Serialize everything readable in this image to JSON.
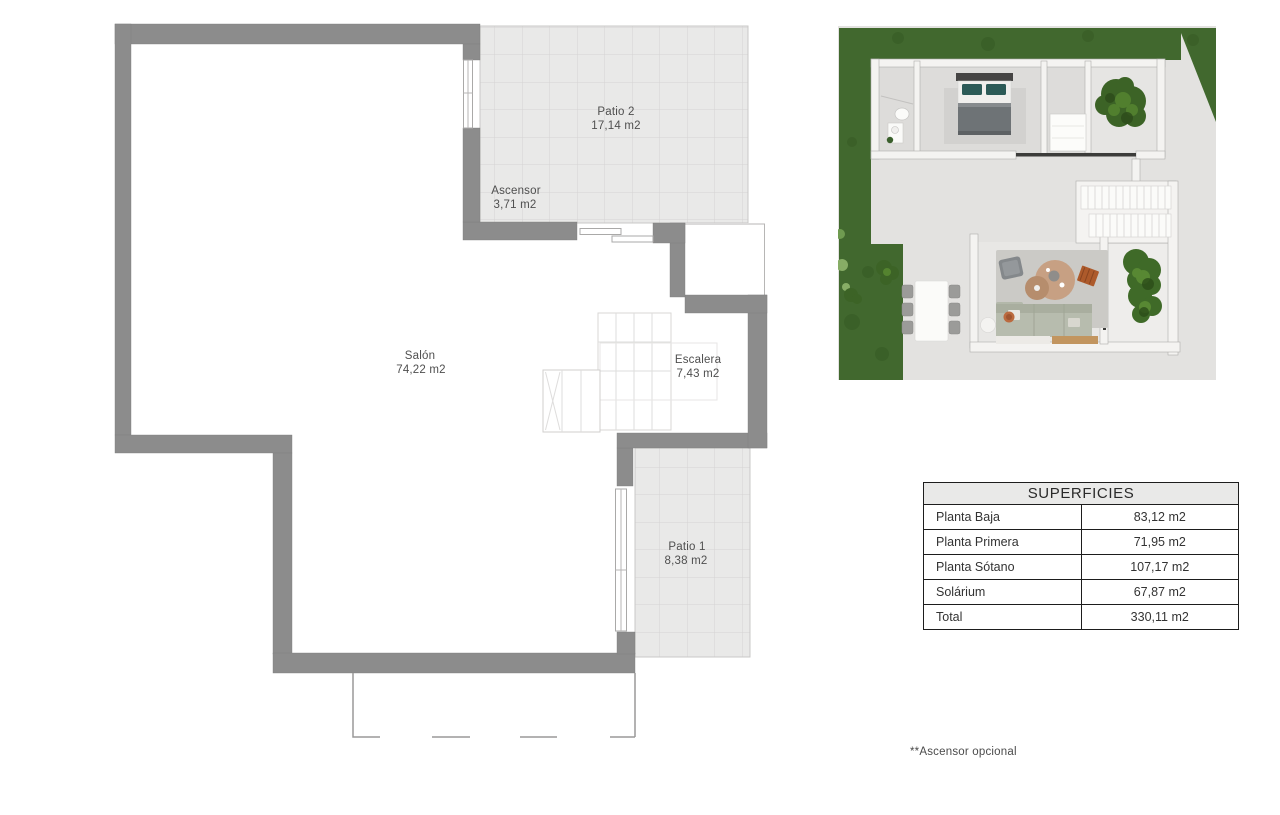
{
  "floorplan": {
    "labels": {
      "patio2": {
        "name": "Patio 2",
        "area": "17,14 m2"
      },
      "ascensor": {
        "name": "Ascensor",
        "area": "3,71 m2"
      },
      "salon": {
        "name": "Salón",
        "area": "74,22 m2"
      },
      "escalera": {
        "name": "Escalera",
        "area": "7,43 m2"
      },
      "patio1": {
        "name": "Patio 1",
        "area": "8,38 m2"
      }
    },
    "colors": {
      "wall": "#8c8c8c",
      "tile_fill": "#e9e9e8",
      "tile_line": "#d5d4d3",
      "outline": "#b7b6b5",
      "text": "#4f4f4f"
    }
  },
  "surfaces_table": {
    "title": "SUPERFICIES",
    "rows": [
      {
        "label": "Planta Baja",
        "value": "83,12 m2"
      },
      {
        "label": "Planta Primera",
        "value": "71,95 m2"
      },
      {
        "label": "Planta Sótano",
        "value": "107,17 m2"
      },
      {
        "label": "Solárium",
        "value": "67,87 m2"
      },
      {
        "label": "Total",
        "value": "330,11 m2"
      }
    ],
    "header_bg": "#e9e9e8",
    "border_color": "#1d1d1d"
  },
  "footnote": {
    "text": "**Ascensor opcional"
  },
  "render": {
    "colors": {
      "grass": "#41682e",
      "grass_dark": "#365a24",
      "grass_light": "#87ad66",
      "concrete": "#e3e2e0",
      "wall": "#f4f3f1",
      "floor": "#dddcda",
      "bush": "#3c6326",
      "bush_light": "#54832f",
      "rug": "#cbcac6",
      "round_rug": "#c7a083",
      "sofa": "#b7bcae",
      "bed_blanket": "#6e7376",
      "pillow": "#2c5a57",
      "wood": "#c2955f",
      "bench": "#ad5a2b",
      "chair": "#9b9b99"
    }
  }
}
